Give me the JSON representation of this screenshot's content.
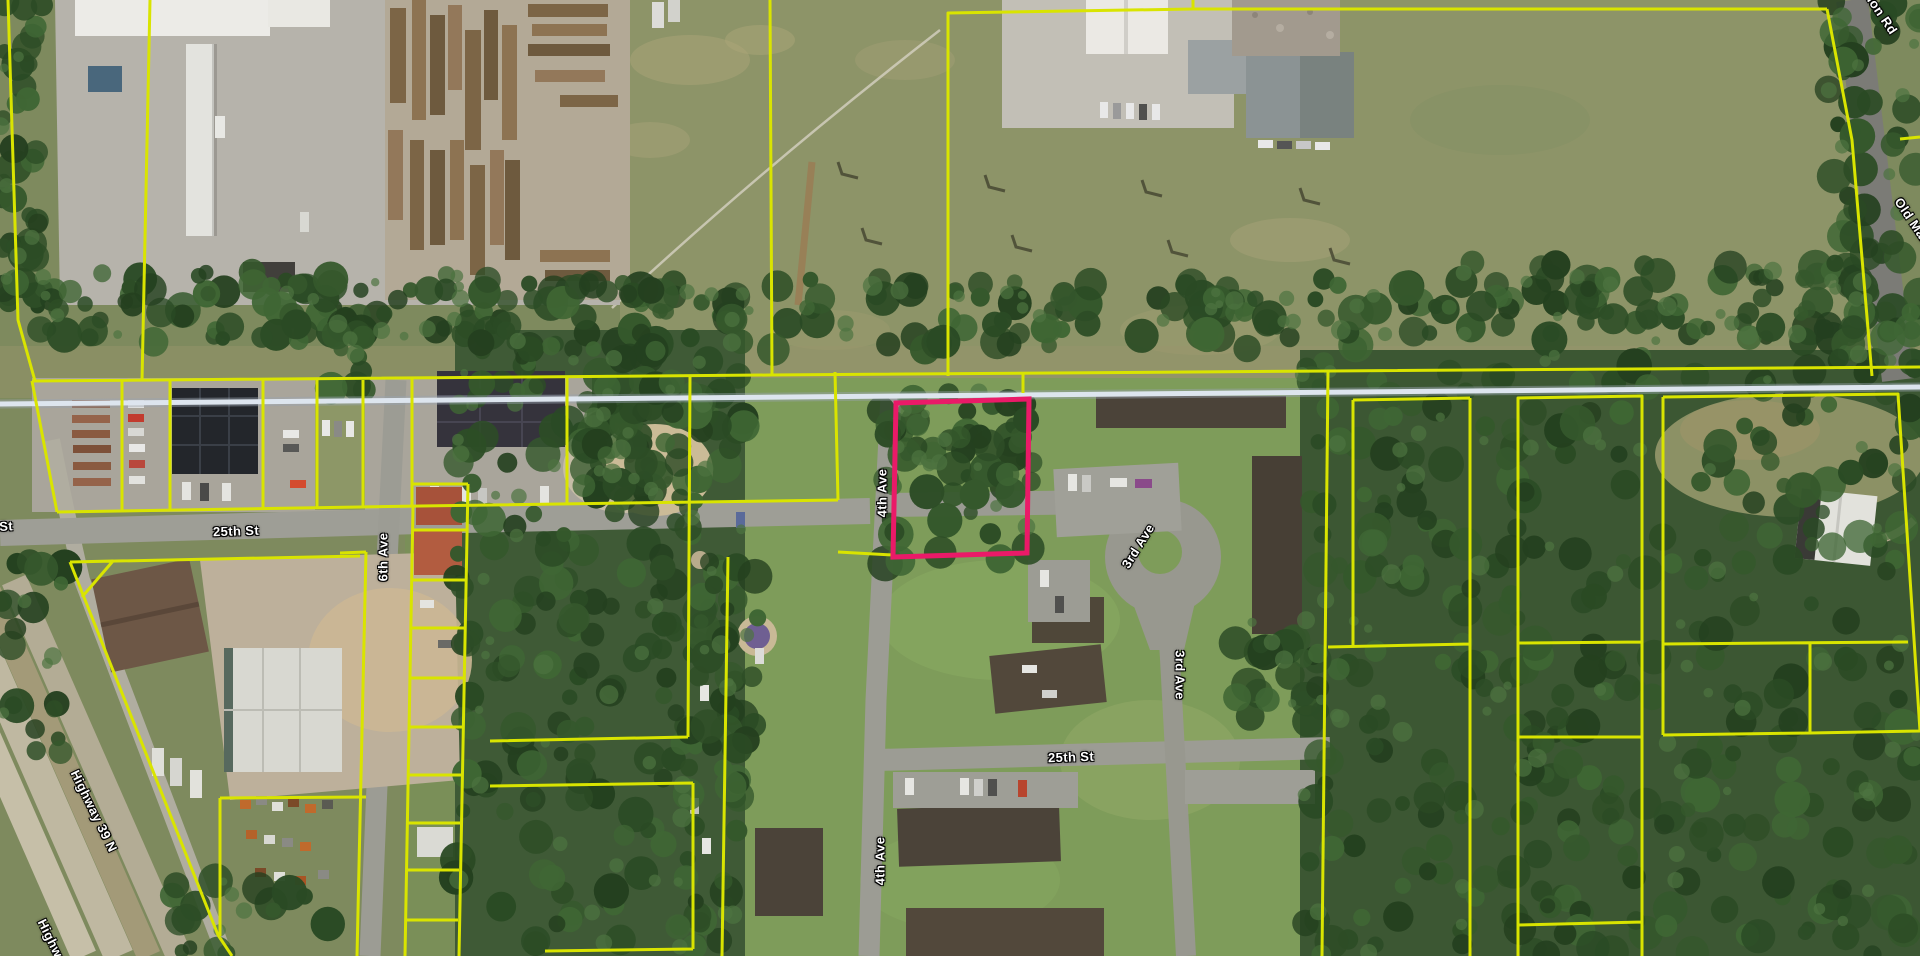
{
  "map": {
    "type": "parcel-map-satellite-view",
    "colors": {
      "parcel_line": "#d9e400",
      "selected_parcel": "#ea1a68",
      "railroad": "#dde5ee",
      "label_color": "#ffffff"
    },
    "selected_parcel": {
      "description": "highlighted wooded parcel north of apartment complex, east of 4th Ave",
      "outline_color": "#ea1a68"
    },
    "labels": [
      {
        "text": "25th St",
        "x": -10,
        "y": 527,
        "rotate": -3
      },
      {
        "text": "25th St",
        "x": 236,
        "y": 531,
        "rotate": -2
      },
      {
        "text": "25th St",
        "x": 1071,
        "y": 757,
        "rotate": -2
      },
      {
        "text": "6th Ave",
        "x": 383,
        "y": 557,
        "rotate": -90
      },
      {
        "text": "4th Ave",
        "x": 882,
        "y": 493,
        "rotate": -90
      },
      {
        "text": "4th Ave",
        "x": 880,
        "y": 861,
        "rotate": -90
      },
      {
        "text": "3rd Ave",
        "x": 1138,
        "y": 546,
        "rotate": -58
      },
      {
        "text": "3rd Ave",
        "x": 1180,
        "y": 675,
        "rotate": 90
      },
      {
        "text": "Highway 39 N",
        "x": 94,
        "y": 811,
        "rotate": 64
      },
      {
        "text": "Highway 39 N",
        "x": 61,
        "y": 960,
        "rotate": 64
      },
      {
        "text": "Old Marion Rd",
        "x": 1868,
        "y": -6,
        "rotate": 56
      },
      {
        "text": "Old Marion Rd",
        "x": 1924,
        "y": 238,
        "rotate": 56
      }
    ]
  }
}
